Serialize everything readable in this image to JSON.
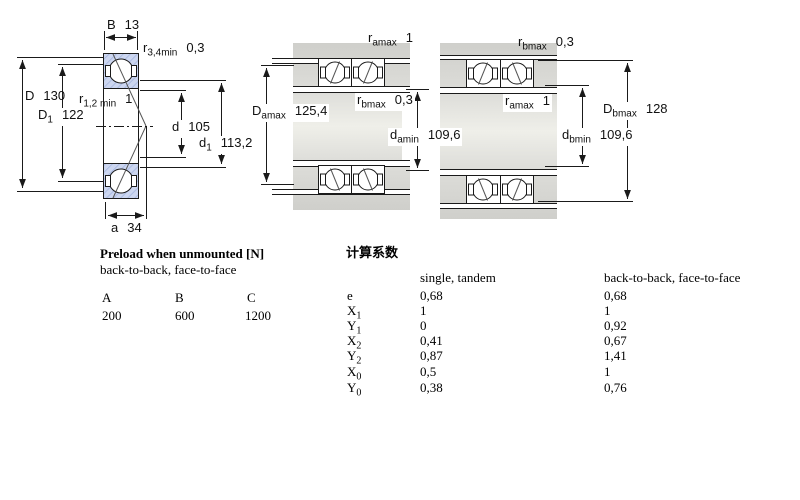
{
  "drawings": {
    "left": {
      "b": {
        "base": "B",
        "sub": "",
        "value": "13"
      },
      "r34": {
        "base": "r",
        "sub": "3,4min",
        "value": "0,3"
      },
      "r12": {
        "base": "r",
        "sub": "1,2 min",
        "value": "1"
      },
      "D": {
        "base": "D",
        "sub": "",
        "value": "130"
      },
      "D1": {
        "base": "D",
        "sub": "1",
        "value": "122"
      },
      "d": {
        "base": "d",
        "sub": "",
        "value": "105"
      },
      "d1": {
        "base": "d",
        "sub": "1",
        "value": "113,2"
      },
      "a": {
        "base": "a",
        "sub": "",
        "value": "34"
      }
    },
    "middle": {
      "ramax": {
        "base": "r",
        "sub": "amax",
        "value": "1"
      },
      "rbmax": {
        "base": "r",
        "sub": "bmax",
        "value": "0,3"
      },
      "Damax": {
        "base": "D",
        "sub": "amax",
        "value": "125,4"
      },
      "damin": {
        "base": "d",
        "sub": "amin",
        "value": "109,6"
      }
    },
    "right": {
      "rbmax": {
        "base": "r",
        "sub": "bmax",
        "value": "0,3"
      },
      "ramax": {
        "base": "r",
        "sub": "amax",
        "value": "1"
      },
      "Dbmax": {
        "base": "D",
        "sub": "bmax",
        "value": "128"
      },
      "dbmin": {
        "base": "d",
        "sub": "bmin",
        "value": "109,6"
      }
    }
  },
  "preload_table": {
    "title": "Preload when unmounted [N]",
    "subtitle": "back-to-back, face-to-face",
    "columns": [
      "A",
      "B",
      "C"
    ],
    "values": [
      "200",
      "600",
      "1200"
    ]
  },
  "factors_table": {
    "title": "计算系数",
    "columns": {
      "single": "single, tandem",
      "paired": "back-to-back, face-to-face"
    },
    "rows": [
      {
        "base": "e",
        "sub": "",
        "single": "0,68",
        "paired": "0,68"
      },
      {
        "base": "X",
        "sub": "1",
        "single": "1",
        "paired": "1"
      },
      {
        "base": "Y",
        "sub": "1",
        "single": "0",
        "paired": "0,92"
      },
      {
        "base": "X",
        "sub": "2",
        "single": "0,41",
        "paired": "0,67"
      },
      {
        "base": "Y",
        "sub": "2",
        "single": "0,87",
        "paired": "1,41"
      },
      {
        "base": "X",
        "sub": "0",
        "single": "0,5",
        "paired": "1"
      },
      {
        "base": "Y",
        "sub": "0",
        "single": "0,38",
        "paired": "0,76"
      }
    ]
  },
  "colors": {
    "ring_fill": "#ccd6f0",
    "ring_hatch": "#9fb1dd",
    "steel_grey": "#d4d4d0",
    "line": "#1a1a1a"
  }
}
